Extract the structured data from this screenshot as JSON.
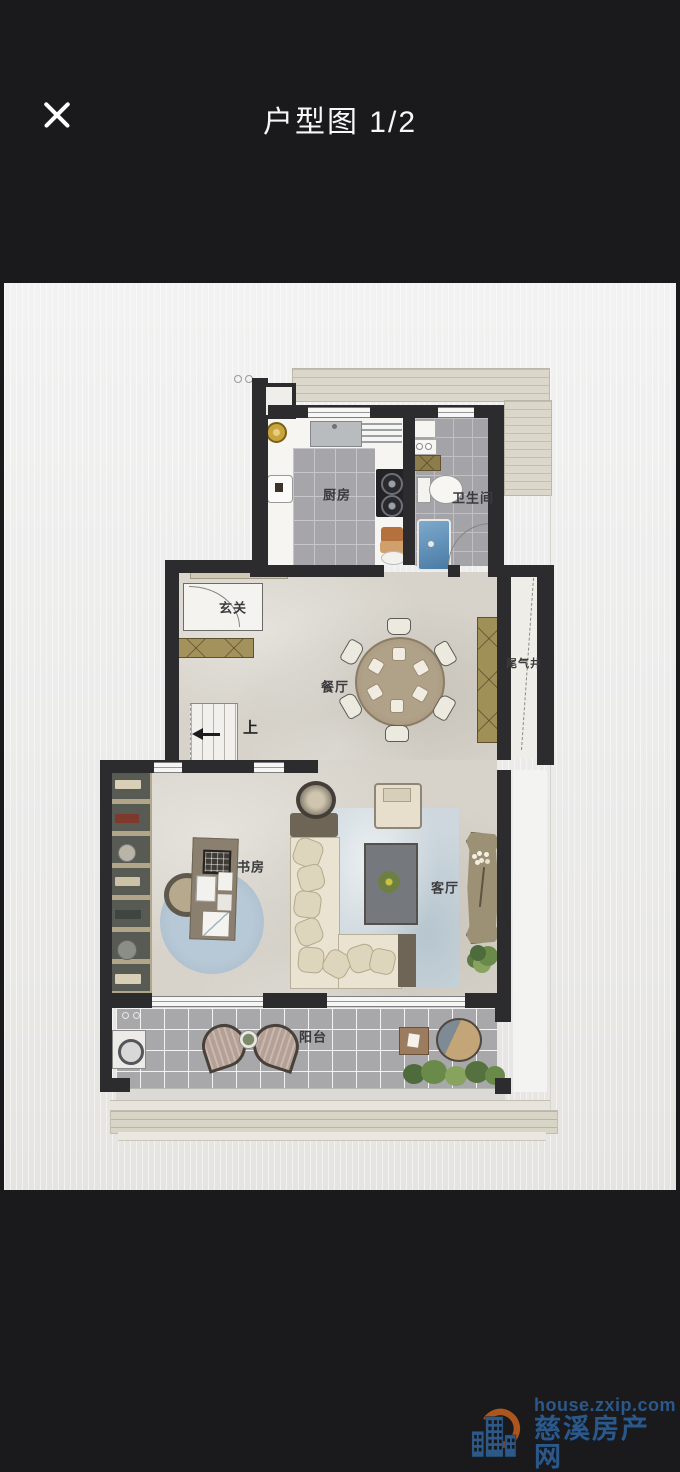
{
  "header": {
    "title": "户型图 1/2"
  },
  "floor_plan": {
    "labels": {
      "kitchen": "厨房",
      "bathroom": "卫生间",
      "foyer": "玄关",
      "dining": "餐厅",
      "exhaust_shaft": "尾气井",
      "stairs_up": "上",
      "study": "书房",
      "living": "客厅",
      "balcony": "阳台"
    }
  },
  "watermark": {
    "site": "house.zxip.com",
    "name": "慈溪房产网"
  },
  "colors": {
    "header_bg": "#1a1a1c",
    "wall": "#2c2c2e",
    "watermark_blue": "#2d5c8f",
    "watermark_orange": "#b4591c"
  }
}
